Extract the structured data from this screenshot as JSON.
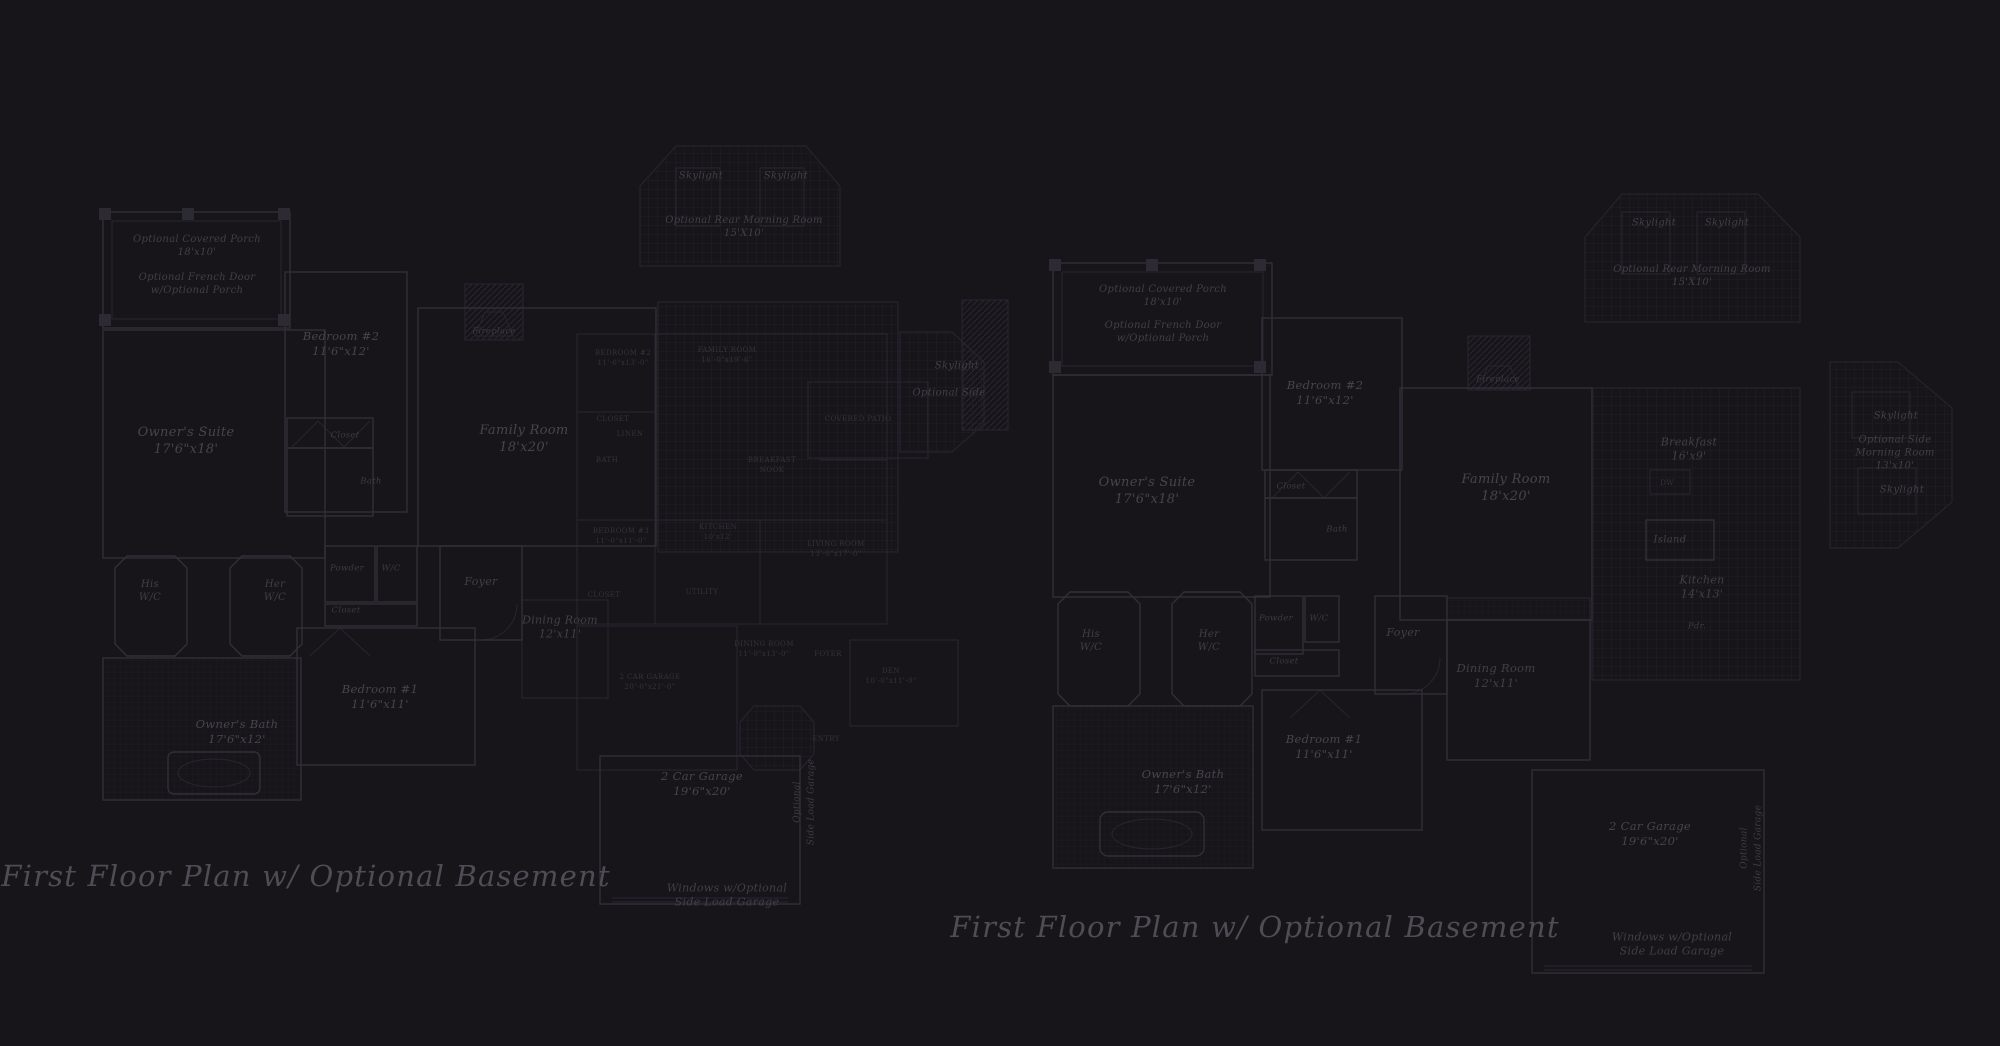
{
  "colors": {
    "bg": "#171519",
    "line": "#312f38",
    "line_faint": "#272531",
    "text": "#46444d",
    "caption": "#4e4c55"
  },
  "plans": [
    {
      "id": "left",
      "name": "first-floor-plan-left",
      "caption": "First Floor Plan  w/ Optional Basement",
      "labels": [
        {
          "x": 197,
          "y": 246,
          "t": "Optional Covered Porch\n18'x10'",
          "k": "sub"
        },
        {
          "x": 197,
          "y": 284,
          "t": "Optional French Door\nw/Optional Porch",
          "k": "sub"
        },
        {
          "x": 186,
          "y": 442,
          "t": "Owner's Suite\n17'6\"x18'",
          "k": "room"
        },
        {
          "x": 341,
          "y": 344,
          "t": "Bedroom #2\n11'6\"x12'",
          "k": "room",
          "s": 11.5
        },
        {
          "x": 345,
          "y": 436,
          "t": "Closet",
          "k": "tiny"
        },
        {
          "x": 371,
          "y": 482,
          "t": "Bath",
          "k": "tiny"
        },
        {
          "x": 494,
          "y": 332,
          "t": "Fireplace",
          "k": "tiny"
        },
        {
          "x": 524,
          "y": 440,
          "t": "Family Room\n18'x20'",
          "k": "room"
        },
        {
          "x": 701,
          "y": 176,
          "t": "Skylight",
          "k": "sub"
        },
        {
          "x": 786,
          "y": 176,
          "t": "Skylight",
          "k": "sub"
        },
        {
          "x": 744,
          "y": 227,
          "t": "Optional Rear Morning Room\n15'X10'",
          "k": "sub"
        },
        {
          "x": 957,
          "y": 366,
          "t": "Skylight",
          "k": "sub"
        },
        {
          "x": 949,
          "y": 393,
          "t": "Optional Side",
          "k": "sub"
        },
        {
          "x": 150,
          "y": 591,
          "t": "His\nW/C",
          "k": "sub"
        },
        {
          "x": 275,
          "y": 591,
          "t": "Her\nW/C",
          "k": "sub"
        },
        {
          "x": 347,
          "y": 569,
          "t": "Powder",
          "k": "tiny"
        },
        {
          "x": 391,
          "y": 569,
          "t": "W/C",
          "k": "tiny"
        },
        {
          "x": 346,
          "y": 611,
          "t": "Closet",
          "k": "tiny"
        },
        {
          "x": 481,
          "y": 582,
          "t": "Foyer",
          "k": "sub",
          "s": 11
        },
        {
          "x": 560,
          "y": 628,
          "t": "Dining Room\n12'x11'",
          "k": "sub",
          "s": 11
        },
        {
          "x": 380,
          "y": 697,
          "t": "Bedroom #1\n11'6\"x11'",
          "k": "room",
          "s": 11.5
        },
        {
          "x": 237,
          "y": 732,
          "t": "Owner's Bath\n17'6\"x12'",
          "k": "room",
          "s": 11.5
        },
        {
          "x": 702,
          "y": 784,
          "t": "2 Car Garage\n19'6\"x20'",
          "k": "room",
          "s": 11.5
        },
        {
          "x": 805,
          "y": 802,
          "t": "Optional\nSide Load Garage",
          "k": "vert"
        },
        {
          "x": 727,
          "y": 896,
          "t": "Windows w/Optional\nSide Load Garage",
          "k": "sub",
          "s": 11
        },
        {
          "x": 623,
          "y": 358,
          "t": "BEDROOM #2\n11'-0\"x13'-0\"",
          "k": "caps"
        },
        {
          "x": 727,
          "y": 355,
          "t": "FAMILY ROOM\n16'-0\"x19'-6\"",
          "k": "caps"
        },
        {
          "x": 613,
          "y": 419,
          "t": "CLOSET",
          "k": "caps"
        },
        {
          "x": 630,
          "y": 434,
          "t": "LINEN",
          "k": "caps"
        },
        {
          "x": 607,
          "y": 460,
          "t": "BATH",
          "k": "caps"
        },
        {
          "x": 772,
          "y": 465,
          "t": "BREAKFAST\nNOOK",
          "k": "caps"
        },
        {
          "x": 858,
          "y": 419,
          "t": "COVERED PATIO",
          "k": "caps"
        },
        {
          "x": 621,
          "y": 536,
          "t": "BEDROOM #3\n11'-0\"x11'-0\"",
          "k": "caps"
        },
        {
          "x": 718,
          "y": 532,
          "t": "KITCHEN\n10'x12'",
          "k": "caps"
        },
        {
          "x": 836,
          "y": 549,
          "t": "LIVING ROOM\n13'-0\"x17'-0\"",
          "k": "caps"
        },
        {
          "x": 604,
          "y": 595,
          "t": "CLOSET",
          "k": "caps"
        },
        {
          "x": 702,
          "y": 592,
          "t": "UTILITY",
          "k": "caps"
        },
        {
          "x": 764,
          "y": 649,
          "t": "DINING ROOM\n11'-0\"x13'-0\"",
          "k": "caps"
        },
        {
          "x": 828,
          "y": 654,
          "t": "FOYER",
          "k": "caps"
        },
        {
          "x": 891,
          "y": 676,
          "t": "DEN\n10'-0\"x11'-0\"",
          "k": "caps"
        },
        {
          "x": 650,
          "y": 682,
          "t": "2 CAR GARAGE\n20'-0\"x21'-0\"",
          "k": "caps"
        },
        {
          "x": 826,
          "y": 739,
          "t": "ENTRY",
          "k": "caps"
        }
      ]
    },
    {
      "id": "right",
      "name": "first-floor-plan-right",
      "caption": "First Floor Plan  w/ Optional Basement",
      "labels": [
        {
          "x": 1163,
          "y": 296,
          "t": "Optional Covered Porch\n18'x10'",
          "k": "sub"
        },
        {
          "x": 1163,
          "y": 332,
          "t": "Optional French Door\nw/Optional Porch",
          "k": "sub"
        },
        {
          "x": 1325,
          "y": 393,
          "t": "Bedroom #2\n11'6\"x12'",
          "k": "room",
          "s": 11.5
        },
        {
          "x": 1291,
          "y": 487,
          "t": "Closet",
          "k": "tiny"
        },
        {
          "x": 1337,
          "y": 530,
          "t": "Bath",
          "k": "tiny"
        },
        {
          "x": 1147,
          "y": 492,
          "t": "Owner's Suite\n17'6\"x18'",
          "k": "room"
        },
        {
          "x": 1498,
          "y": 380,
          "t": "Fireplace",
          "k": "tiny"
        },
        {
          "x": 1506,
          "y": 489,
          "t": "Family Room\n18'x20'",
          "k": "room"
        },
        {
          "x": 1654,
          "y": 223,
          "t": "Skylight",
          "k": "sub"
        },
        {
          "x": 1727,
          "y": 223,
          "t": "Skylight",
          "k": "sub"
        },
        {
          "x": 1692,
          "y": 276,
          "t": "Optional Rear Morning Room\n15'X10'",
          "k": "sub"
        },
        {
          "x": 1689,
          "y": 450,
          "t": "Breakfast\n16'x9'",
          "k": "sub",
          "s": 11
        },
        {
          "x": 1667,
          "y": 483,
          "t": "DW",
          "k": "caps"
        },
        {
          "x": 1670,
          "y": 540,
          "t": "Island",
          "k": "sub"
        },
        {
          "x": 1702,
          "y": 588,
          "t": "Kitchen\n14'x13'",
          "k": "sub",
          "s": 11
        },
        {
          "x": 1697,
          "y": 627,
          "t": "Pdr.",
          "k": "tiny"
        },
        {
          "x": 1896,
          "y": 416,
          "t": "Skylight",
          "k": "sub"
        },
        {
          "x": 1895,
          "y": 453,
          "t": "Optional Side\nMorning Room\n13'x10'",
          "k": "sub"
        },
        {
          "x": 1902,
          "y": 490,
          "t": "Skylight",
          "k": "sub"
        },
        {
          "x": 1091,
          "y": 641,
          "t": "His\nW/C",
          "k": "sub"
        },
        {
          "x": 1209,
          "y": 641,
          "t": "Her\nW/C",
          "k": "sub"
        },
        {
          "x": 1276,
          "y": 619,
          "t": "Powder",
          "k": "tiny"
        },
        {
          "x": 1319,
          "y": 619,
          "t": "W/C",
          "k": "tiny"
        },
        {
          "x": 1284,
          "y": 662,
          "t": "Closet",
          "k": "tiny"
        },
        {
          "x": 1403,
          "y": 633,
          "t": "Foyer",
          "k": "sub",
          "s": 11
        },
        {
          "x": 1496,
          "y": 676,
          "t": "Dining Room\n12'x11'",
          "k": "sub",
          "s": 11.5
        },
        {
          "x": 1324,
          "y": 747,
          "t": "Bedroom #1\n11'6\"x11'",
          "k": "room",
          "s": 11.5
        },
        {
          "x": 1183,
          "y": 782,
          "t": "Owner's Bath\n17'6\"x12'",
          "k": "room",
          "s": 11.5
        },
        {
          "x": 1650,
          "y": 834,
          "t": "2 Car Garage\n19'6\"x20'",
          "k": "room",
          "s": 11.5
        },
        {
          "x": 1752,
          "y": 848,
          "t": "Optional\nSide Load Garage",
          "k": "vert"
        },
        {
          "x": 1672,
          "y": 945,
          "t": "Windows w/Optional\nSide Load Garage",
          "k": "sub",
          "s": 11
        }
      ]
    }
  ]
}
